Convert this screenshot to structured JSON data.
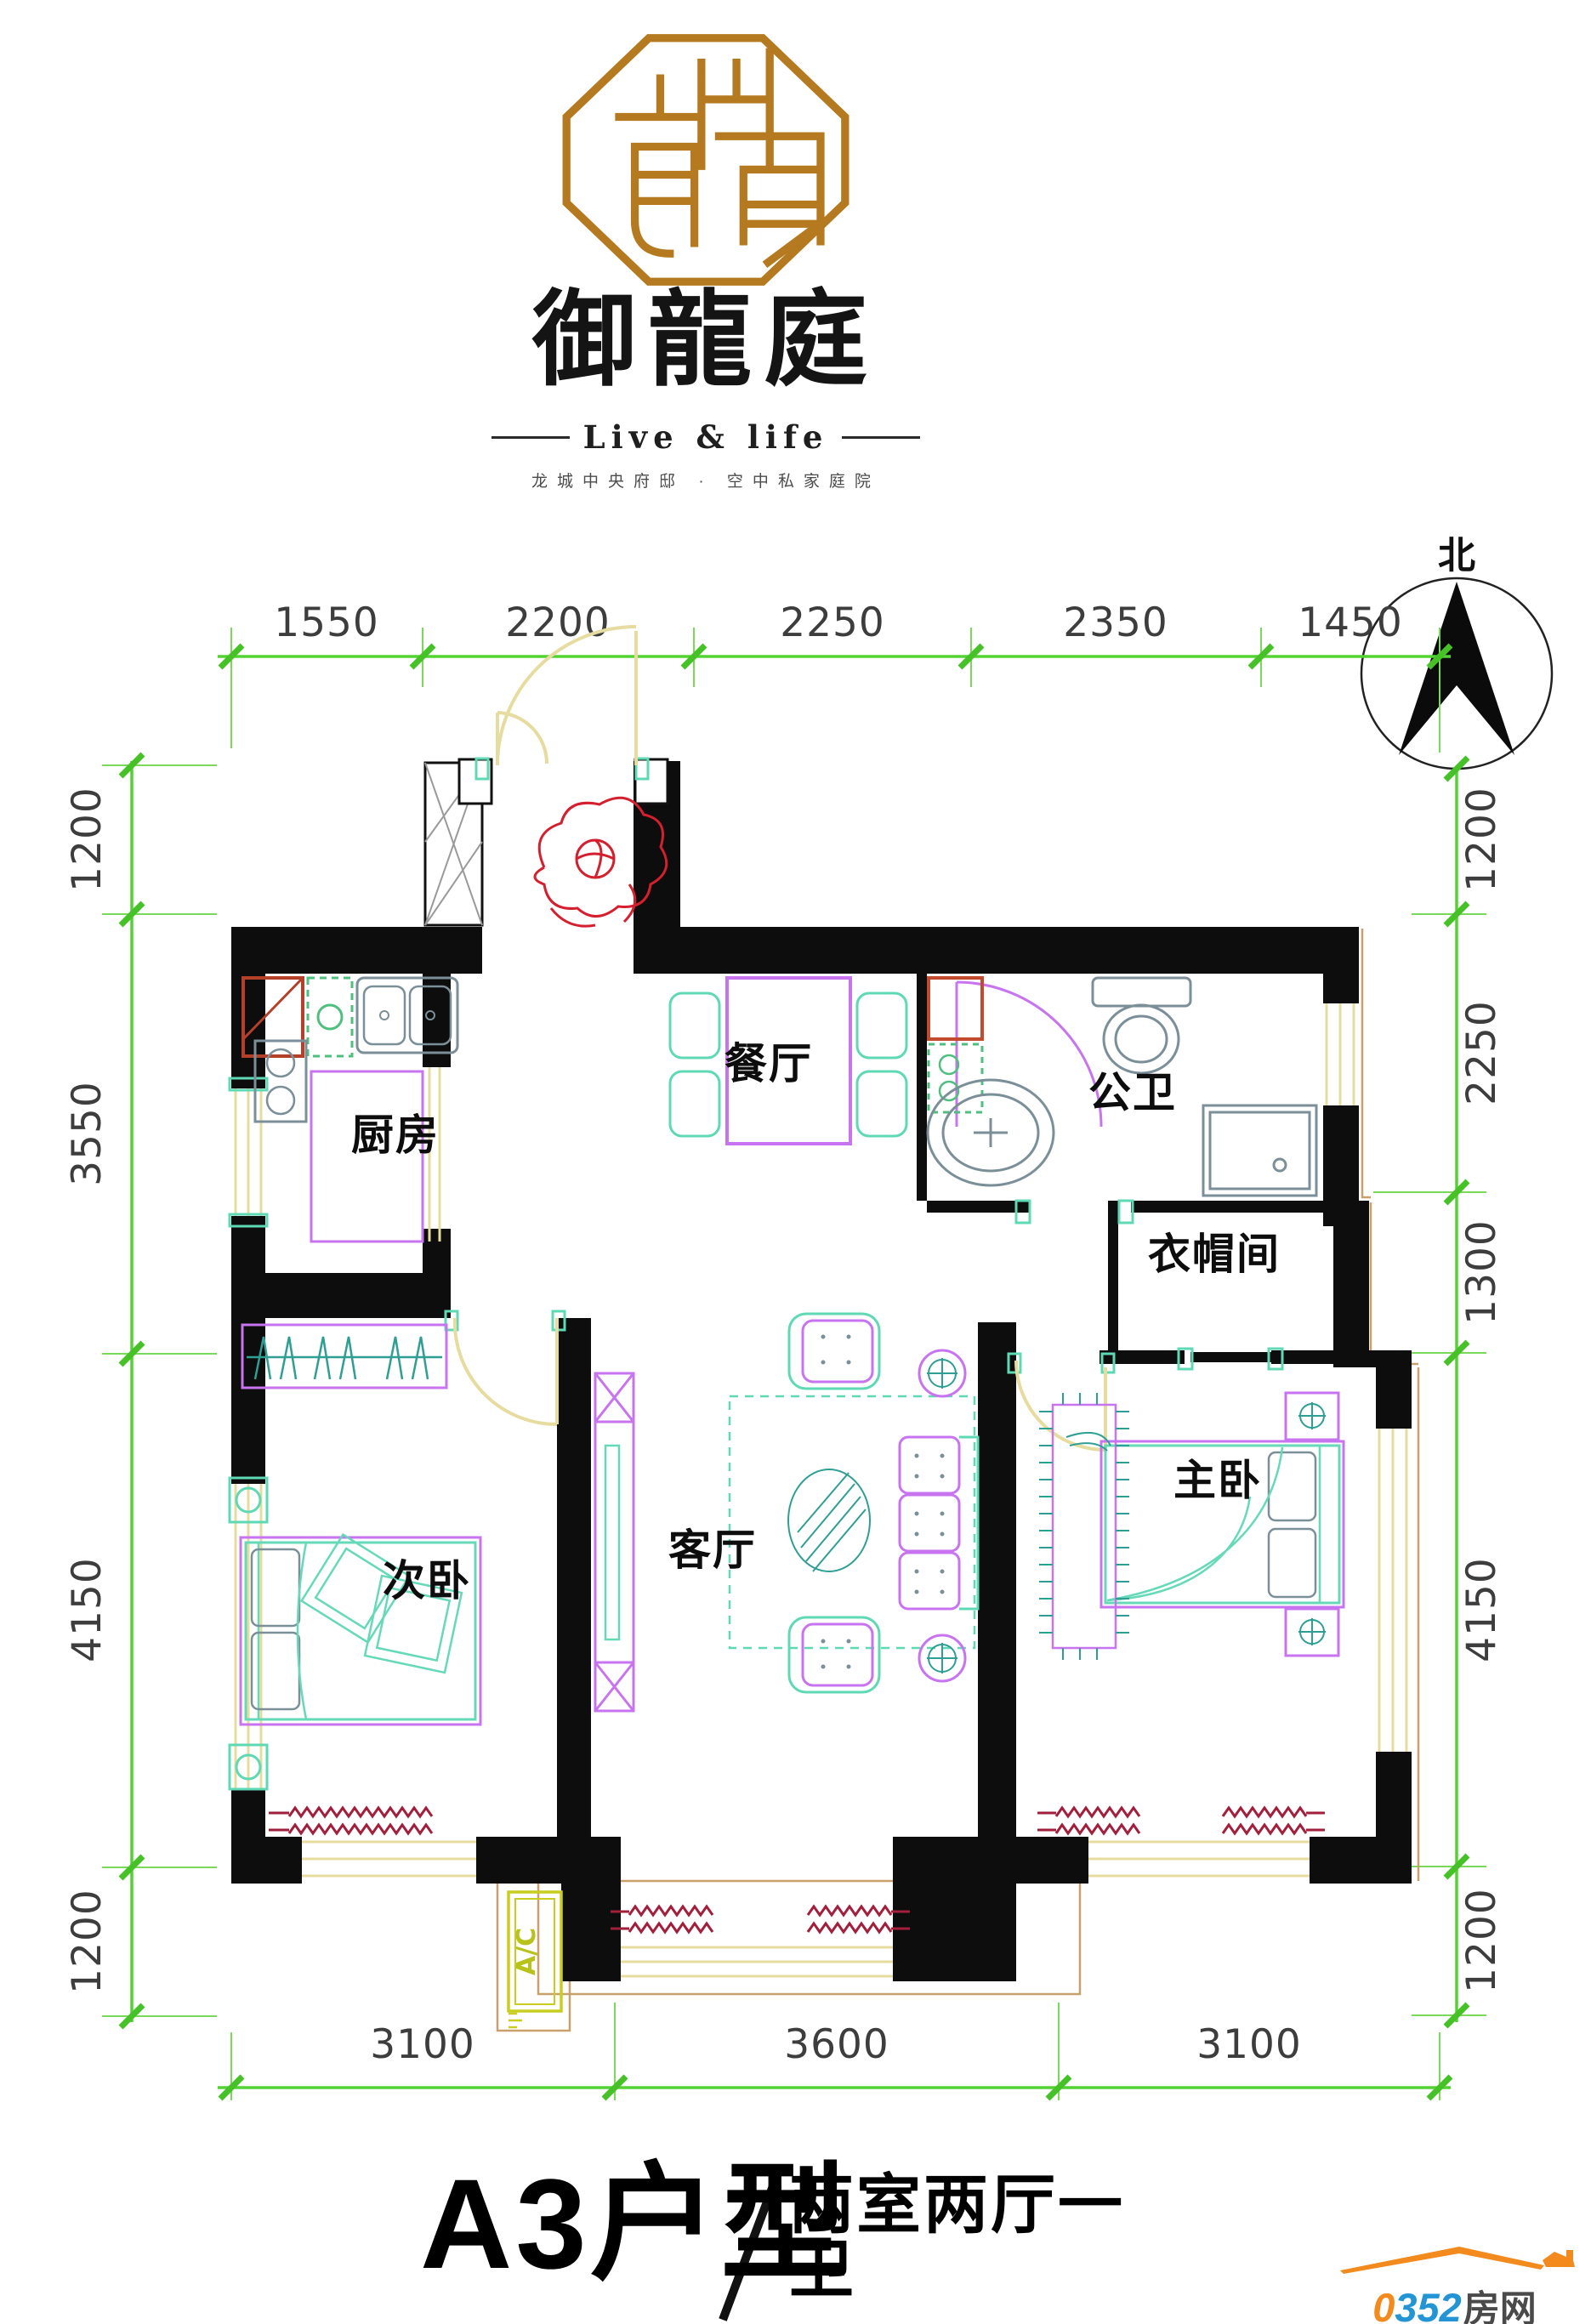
{
  "header": {
    "brand_name": "御龍庭",
    "brand_tagline_en": "Live & life",
    "brand_tagline_cn": "龙城中央府邸 · 空中私家庭院"
  },
  "north_indicator": {
    "label": "北"
  },
  "floor_plan": {
    "rooms": [
      {
        "id": "kitchen",
        "label": "厨房"
      },
      {
        "id": "dining-room",
        "label": "餐厅"
      },
      {
        "id": "bathroom",
        "label": "公卫"
      },
      {
        "id": "cloakroom",
        "label": "衣帽间"
      },
      {
        "id": "second-bedroom",
        "label": "次卧"
      },
      {
        "id": "living-room",
        "label": "客厅"
      },
      {
        "id": "master-bedroom",
        "label": "主卧"
      }
    ],
    "ac_label": "A/C"
  },
  "dimensions": {
    "top": [
      "1550",
      "2200",
      "2250",
      "2350",
      "1450"
    ],
    "left": [
      "1200",
      "3550",
      "4150",
      "1200"
    ],
    "right": [
      "1200",
      "2250",
      "1300",
      "4150",
      "1200"
    ],
    "bottom": [
      "3100",
      "3600",
      "3100"
    ]
  },
  "footer": {
    "unit_name": "A3户型",
    "unit_layout": "两室两厅一卫",
    "unit_area": "建筑面积：102.87平米"
  },
  "watermark": {
    "brand_zero": "0",
    "brand_number": "352",
    "brand_suffix": "房网",
    "url": "www.0352fang.com"
  },
  "colors": {
    "dimension_green": "#53d333",
    "wall_black": "#0d0d0d",
    "seal_gold": "#b5791f",
    "door_tan": "#e7dc9f",
    "furniture_purple": "#c873f0",
    "furniture_teal": "#5fd9b4",
    "radiator_red": "#a21f3c",
    "accent_red": "#d4202e",
    "brand_blue": "#2395d4",
    "brand_orange": "#f28a1e"
  }
}
